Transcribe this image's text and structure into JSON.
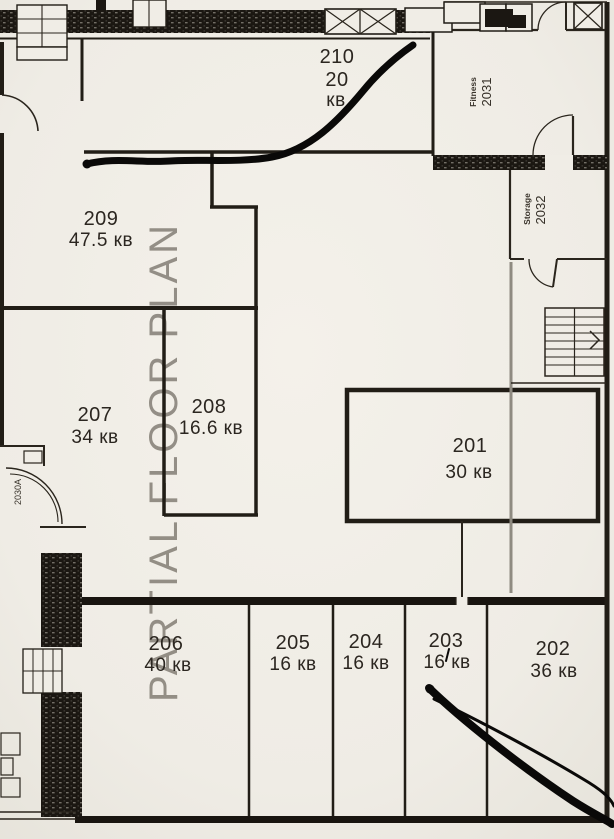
{
  "watermark": "PARTIAL FLOOR PLAN",
  "rooms": {
    "r210": {
      "number": "210",
      "area": "20",
      "unit": "кв"
    },
    "r209": {
      "number": "209",
      "area": "47.5 кв"
    },
    "r208": {
      "number": "208",
      "area": "16.6 кв"
    },
    "r207": {
      "number": "207",
      "area": "34 кв"
    },
    "r201": {
      "number": "201",
      "area": "30 кв"
    },
    "r206": {
      "number": "206",
      "area": "40 кв"
    },
    "r205": {
      "number": "205",
      "area": "16 кв"
    },
    "r204": {
      "number": "204",
      "area": "16 кв"
    },
    "r203": {
      "number": "203",
      "area": "16 кв"
    },
    "r202": {
      "number": "202",
      "area": "36 кв"
    }
  },
  "annex": {
    "fitness_name": "Fitness",
    "fitness_number": "2031",
    "storage_name": "Storage",
    "storage_number": "2032",
    "entry_label": "2030A"
  },
  "colors": {
    "paper": "#f0ede6",
    "ink": "#211d16",
    "marker": "#0a0908",
    "watermark": "#837e75"
  }
}
